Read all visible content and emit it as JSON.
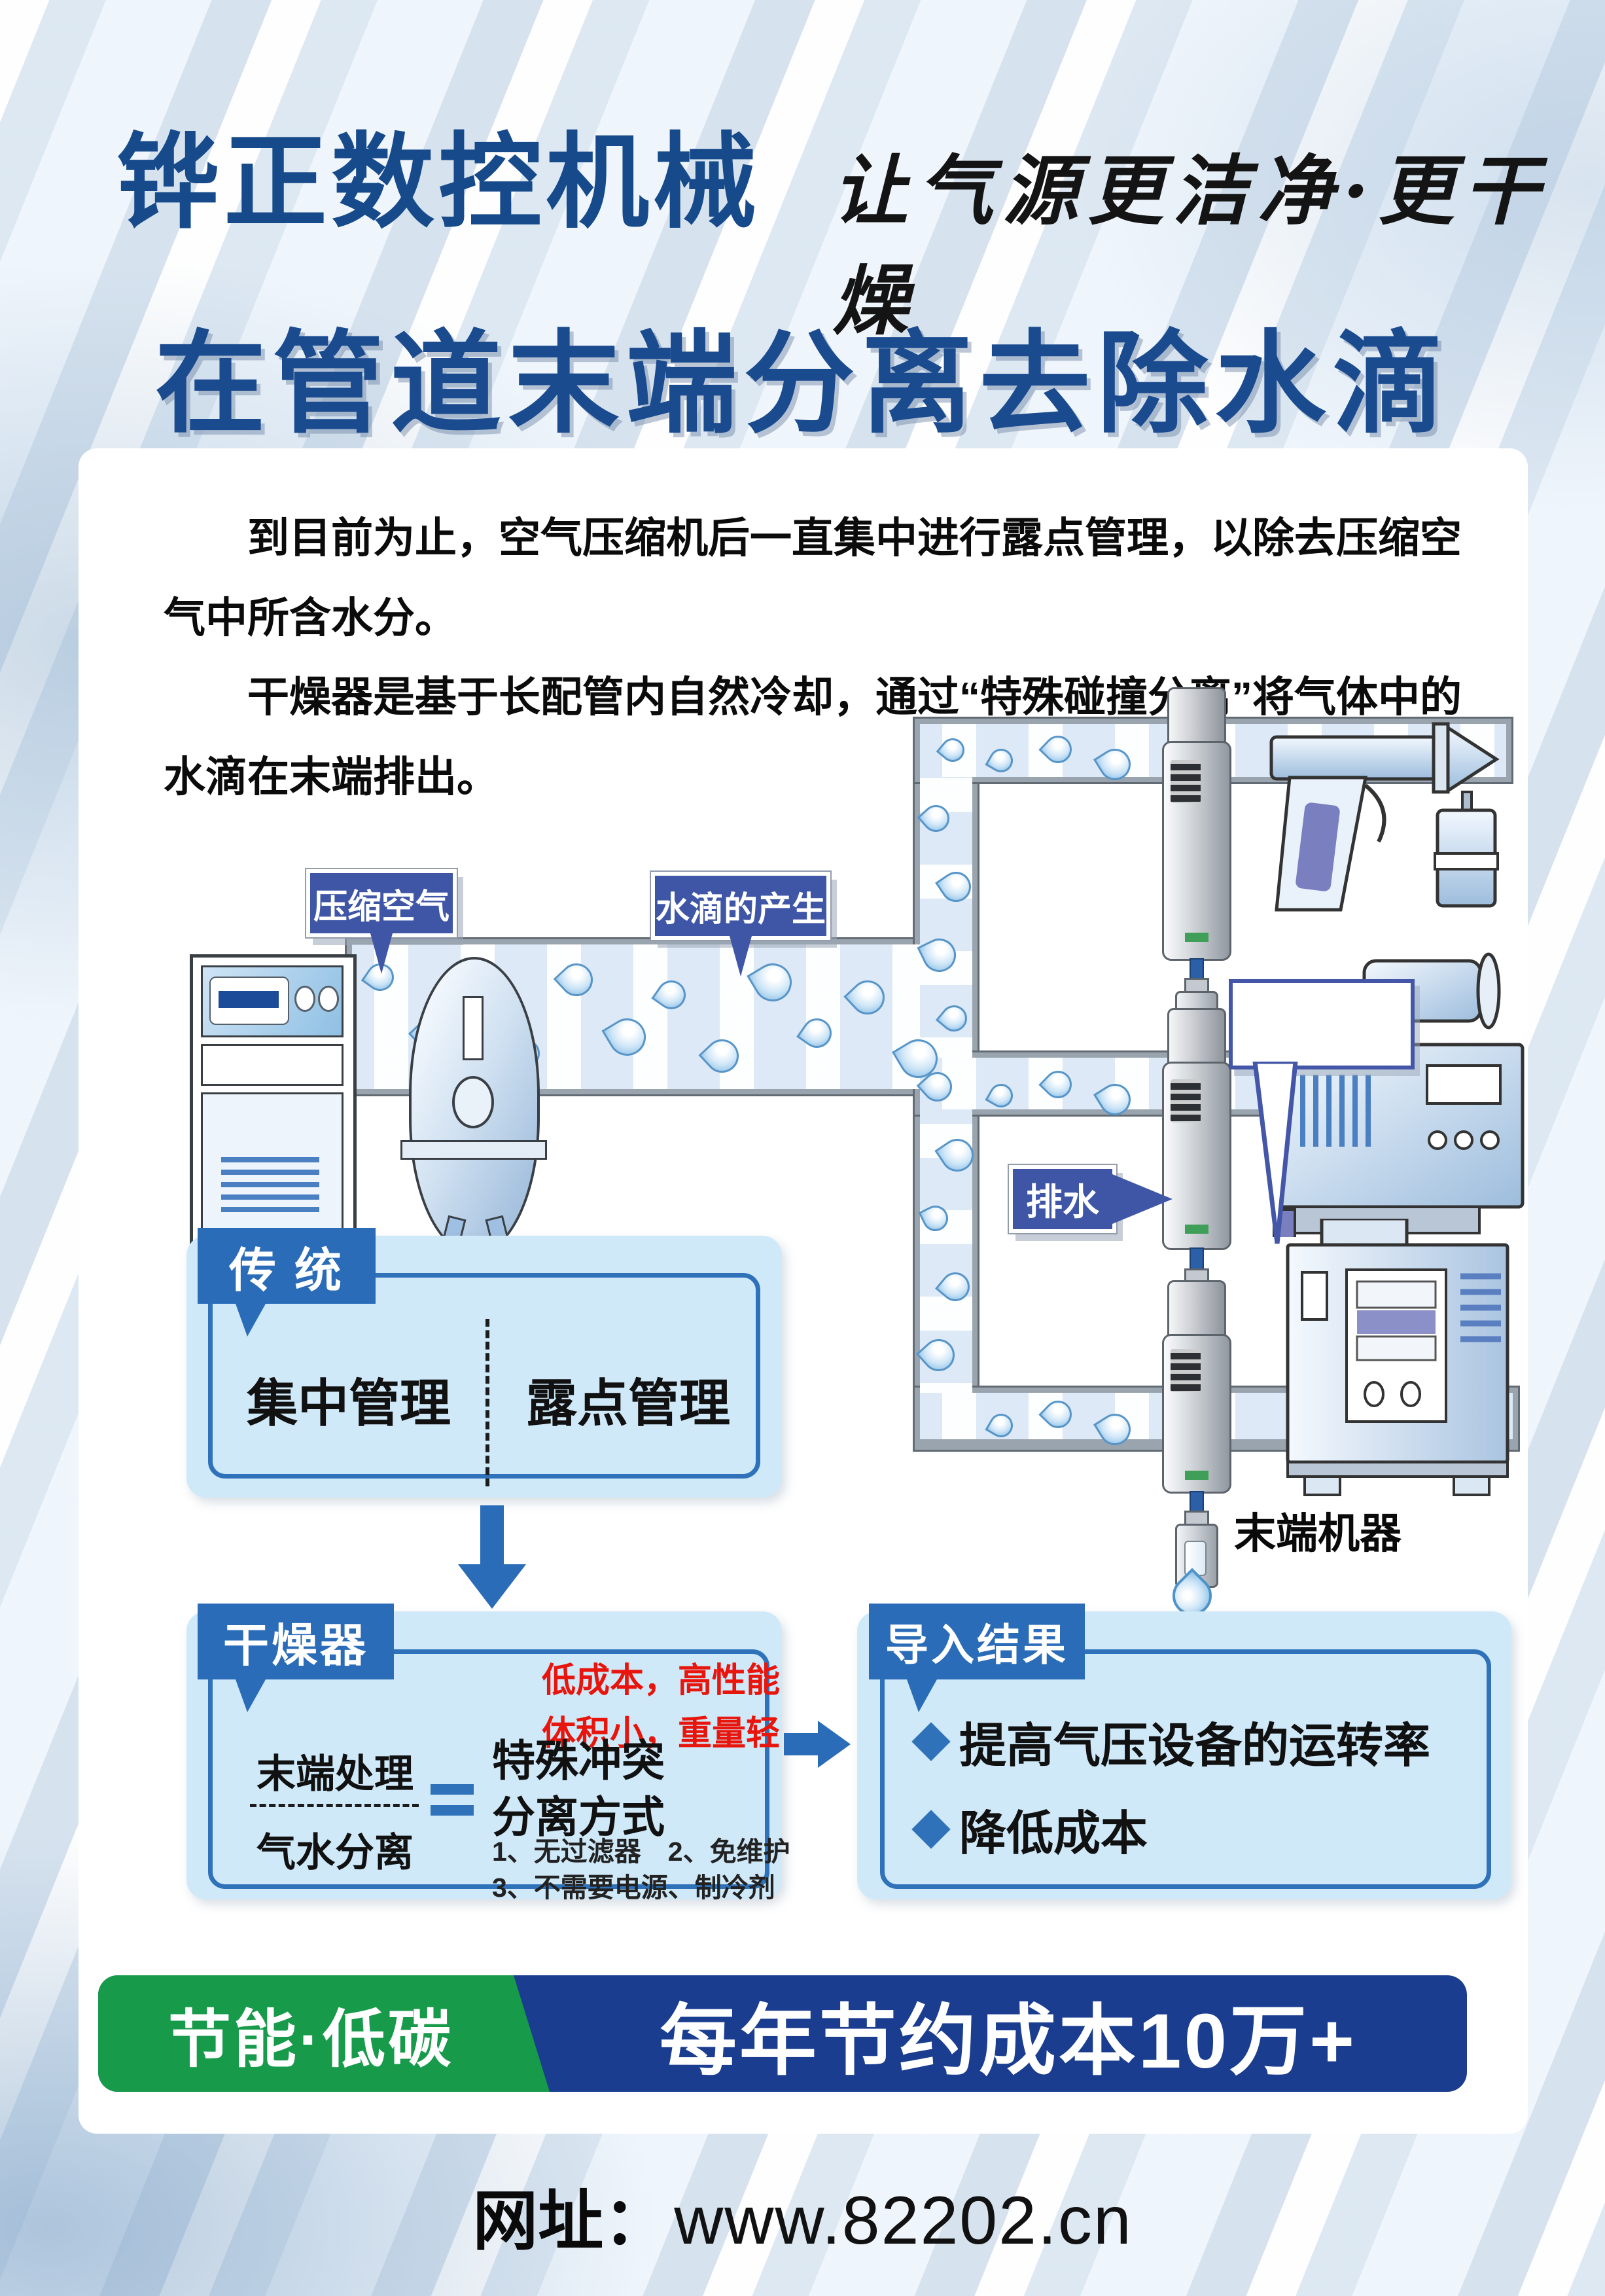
{
  "header": {
    "company": "铧正数控机械",
    "slogan": "让气源更洁净·更干燥"
  },
  "title": "在管道末端分离去除水滴",
  "intro": {
    "paragraph1": "到目前为止，空气压缩机后一直集中进行露点管理，以除去压缩空气中所含水分。",
    "paragraph2": "干燥器是基于长配管内自然冷却，通过“特殊碰撞分离”将气体中的水滴在末端排出。"
  },
  "diagram": {
    "label_compressed_air": "压缩空气",
    "label_water_droplets": "水滴的产生",
    "label_drain": "排水",
    "caption_end_machine": "末端机器"
  },
  "traditional_box": {
    "tag": "传 统",
    "item_left": "集中管理",
    "item_right": "露点管理"
  },
  "dryer_box": {
    "tag": "干燥器",
    "highlight1": "低成本，高性能",
    "highlight2": "体积小，重量轻",
    "term_top": "末端处理",
    "term_bottom": "气水分离",
    "method_line1": "特殊冲突",
    "method_line2": "分离方式",
    "note1": "1、无过滤器　2、免维护",
    "note2": "3、不需要电源、制冷剂"
  },
  "result_box": {
    "tag": "导入结果",
    "bullets": [
      "提高气压设备的运转率",
      "降低成本"
    ]
  },
  "banner": {
    "green_label": "节能·低碳",
    "blue_label": "每年节约成本10万+"
  },
  "footer": {
    "label": "网址：",
    "url": "www.82202.cn"
  },
  "colors": {
    "brand_blue": "#164a8a",
    "title_blue": "#1b4b8f",
    "tag_blue": "#2a6cb8",
    "box_bg": "#cfe9f9",
    "sign_blue": "#3f56a7",
    "accent_red": "#e8150d",
    "green": "#189a4b",
    "navy": "#1a3d8f"
  }
}
